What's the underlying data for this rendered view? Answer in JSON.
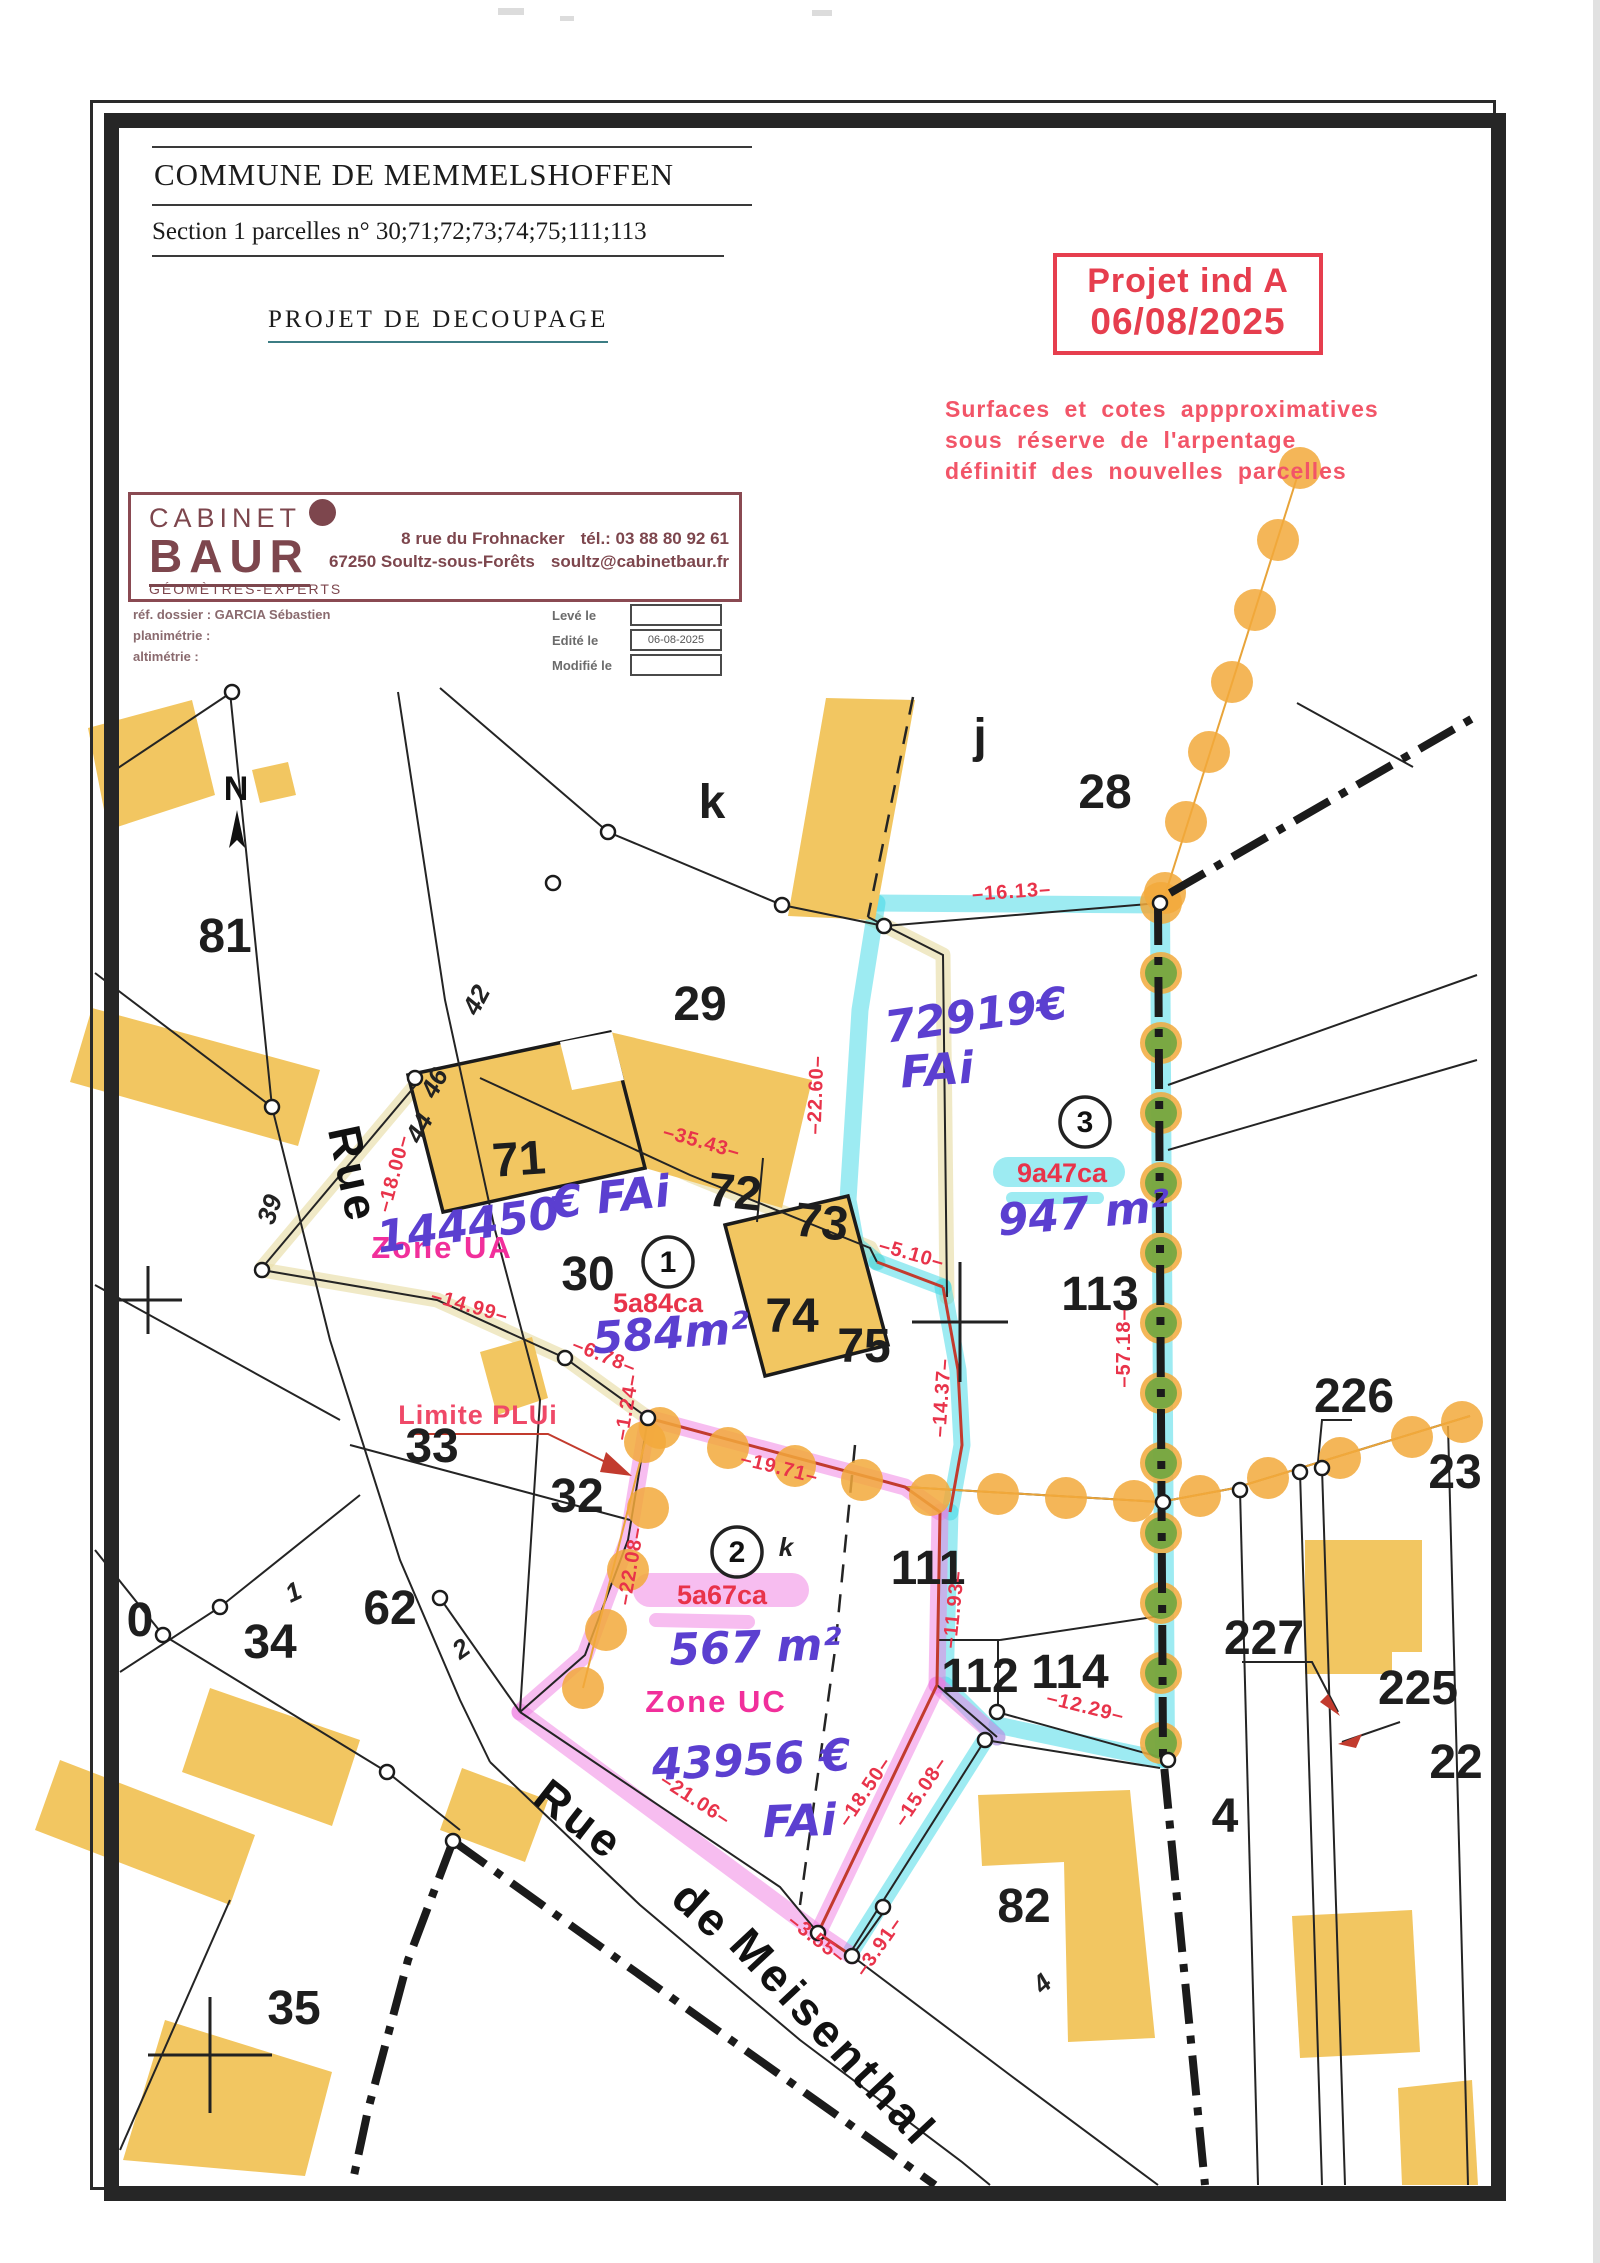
{
  "header": {
    "commune": "COMMUNE DE MEMMELSHOFFEN",
    "section": "Section 1 parcelles n° 30;71;72;73;74;75;111;113",
    "project_title": "PROJET DE DECOUPAGE"
  },
  "stamp": {
    "line1": "Projet ind A",
    "line2": "06/08/2025",
    "color": "#e63e4e"
  },
  "disclaimer": {
    "line1": "Surfaces et cotes appproximatives",
    "line2": "sous réserve de l'arpentage",
    "line3": "définitif des nouvelles parcelles"
  },
  "firm": {
    "name_top": "CABINET",
    "name_main": "BAUR",
    "subtitle": "GÉOMÈTRES-EXPERTS",
    "address_line1": "8 rue du Frohnacker",
    "address_line2": "67250 Soultz-sous-Forêts",
    "tel": "tél.: 03 88 80 92 61",
    "email": "soultz@cabinetbaur.fr",
    "brand_color": "#7d464d"
  },
  "file_info": {
    "ref_label": "réf. dossier : GARCIA Sébastien",
    "plan_label": "planimétrie :",
    "alt_label": "altimétrie :",
    "leve_label": "Levé le",
    "leve_value": "",
    "edite_label": "Edité le",
    "edite_value": "06-08-2025",
    "modifie_label": "Modifié le",
    "modifie_value": ""
  },
  "colors": {
    "building": "#f2c661",
    "orange_dot": "#f2a93b",
    "green_dot": "#5fa53e",
    "cyan_highlight": "#3bd7e6",
    "pink_highlight": "#f07ce2",
    "dim_red": "#e8334a",
    "zone_magenta": "#f12f9b",
    "handwriting_purple": "#5b3fd0"
  },
  "map": {
    "north": {
      "t": "N",
      "x": 236,
      "y": 800
    },
    "parcels": [
      {
        "t": "81",
        "x": 225,
        "y": 952,
        "s": 56
      },
      {
        "t": "29",
        "x": 700,
        "y": 1020,
        "s": 50
      },
      {
        "t": "28",
        "x": 1105,
        "y": 808,
        "s": 48
      },
      {
        "t": "k",
        "x": 712,
        "y": 818,
        "s": 56
      },
      {
        "t": "j",
        "x": 980,
        "y": 752,
        "s": 46
      },
      {
        "t": "71",
        "x": 520,
        "y": 1175,
        "s": 48,
        "r": -4
      },
      {
        "t": "72",
        "x": 733,
        "y": 1208,
        "s": 52,
        "r": 6
      },
      {
        "t": "73",
        "x": 820,
        "y": 1238,
        "s": 52,
        "r": 6
      },
      {
        "t": "30",
        "x": 588,
        "y": 1290,
        "s": 48
      },
      {
        "t": "74",
        "x": 792,
        "y": 1332,
        "s": 48
      },
      {
        "t": "75",
        "x": 864,
        "y": 1362,
        "s": 48
      },
      {
        "t": "113",
        "x": 1100,
        "y": 1310,
        "s": 46
      },
      {
        "t": "33",
        "x": 432,
        "y": 1462,
        "s": 46
      },
      {
        "t": "32",
        "x": 577,
        "y": 1512,
        "s": 44
      },
      {
        "t": "34",
        "x": 270,
        "y": 1658,
        "s": 44
      },
      {
        "t": "62",
        "x": 390,
        "y": 1624,
        "s": 44
      },
      {
        "t": "0",
        "x": 140,
        "y": 1636,
        "s": 44
      },
      {
        "t": "111",
        "x": 928,
        "y": 1584,
        "s": 42
      },
      {
        "t": "112",
        "x": 980,
        "y": 1692,
        "s": 42
      },
      {
        "t": "114",
        "x": 1070,
        "y": 1688,
        "s": 42
      },
      {
        "t": "226",
        "x": 1354,
        "y": 1412,
        "s": 42
      },
      {
        "t": "227",
        "x": 1264,
        "y": 1654,
        "s": 42
      },
      {
        "t": "225",
        "x": 1418,
        "y": 1704,
        "s": 42
      },
      {
        "t": "22",
        "x": 1456,
        "y": 1778,
        "s": 42
      },
      {
        "t": "23",
        "x": 1455,
        "y": 1488,
        "s": 42
      },
      {
        "t": "82",
        "x": 1024,
        "y": 1922,
        "s": 46
      },
      {
        "t": "35",
        "x": 294,
        "y": 2024,
        "s": 44
      },
      {
        "t": "4",
        "x": 1225,
        "y": 1832,
        "s": 46
      }
    ],
    "small_labels": [
      {
        "t": "39",
        "x": 278,
        "y": 1212,
        "r": -72
      },
      {
        "t": "42",
        "x": 484,
        "y": 1004,
        "r": -62
      },
      {
        "t": "46",
        "x": 442,
        "y": 1087,
        "r": -62
      },
      {
        "t": "44",
        "x": 427,
        "y": 1132,
        "r": -62
      },
      {
        "t": "1",
        "x": 297,
        "y": 1600,
        "r": -25
      },
      {
        "t": "2",
        "x": 466,
        "y": 1656,
        "r": -35
      },
      {
        "t": "4",
        "x": 1048,
        "y": 1990,
        "r": -42
      },
      {
        "t": "k",
        "x": 786,
        "y": 1556,
        "s": 40
      }
    ],
    "dims": [
      {
        "t": "–16.13–",
        "x": 1012,
        "y": 898,
        "r": -4
      },
      {
        "t": "–22.60–",
        "x": 822,
        "y": 1095,
        "r": -88
      },
      {
        "t": "–35.43–",
        "x": 700,
        "y": 1148,
        "r": 16
      },
      {
        "t": "–18.00–",
        "x": 400,
        "y": 1175,
        "r": -75
      },
      {
        "t": "–14.99–",
        "x": 468,
        "y": 1312,
        "r": 16
      },
      {
        "t": "–6.78–",
        "x": 602,
        "y": 1362,
        "r": 22
      },
      {
        "t": "–1.24–",
        "x": 633,
        "y": 1408,
        "r": -80
      },
      {
        "t": "–5.10–",
        "x": 910,
        "y": 1260,
        "r": 16
      },
      {
        "t": "–14.37–",
        "x": 948,
        "y": 1398,
        "r": -86
      },
      {
        "t": "–57.18–",
        "x": 1130,
        "y": 1348,
        "r": -90
      },
      {
        "t": "–19.71–",
        "x": 778,
        "y": 1474,
        "r": 14
      },
      {
        "t": "–22.08–",
        "x": 637,
        "y": 1567,
        "r": -80
      },
      {
        "t": "–11.93–",
        "x": 960,
        "y": 1610,
        "r": -84
      },
      {
        "t": "–12.29–",
        "x": 1084,
        "y": 1713,
        "r": 14
      },
      {
        "t": "–18.50–",
        "x": 870,
        "y": 1795,
        "r": -56
      },
      {
        "t": "–15.08–",
        "x": 926,
        "y": 1795,
        "r": -56
      },
      {
        "t": "–21.06–",
        "x": 692,
        "y": 1805,
        "r": 33
      },
      {
        "t": "–3.55–",
        "x": 813,
        "y": 1944,
        "r": 38
      },
      {
        "t": "–3.91–",
        "x": 884,
        "y": 1950,
        "r": -55
      }
    ],
    "areas": [
      {
        "t": "5a84ca",
        "x": 658,
        "y": 1312
      },
      {
        "t": "9a47ca",
        "x": 1062,
        "y": 1182
      },
      {
        "t": "5a67ca",
        "x": 722,
        "y": 1604
      }
    ],
    "lots": [
      {
        "n": "1",
        "x": 668,
        "y": 1262
      },
      {
        "n": "2",
        "x": 737,
        "y": 1552
      },
      {
        "n": "3",
        "x": 1085,
        "y": 1122
      }
    ],
    "zones": [
      {
        "t": "Zone UA",
        "x": 442,
        "y": 1258
      },
      {
        "t": "Zone UC",
        "x": 716,
        "y": 1712
      }
    ],
    "limite": {
      "t": "Limite PLUi",
      "x": 478,
      "y": 1424
    },
    "handwriting": [
      {
        "t": "144450",
        "x": 470,
        "y": 1240,
        "s": 46,
        "r": -8
      },
      {
        "t": "€ FAi",
        "x": 612,
        "y": 1212,
        "s": 38,
        "r": -6,
        "c": "#6a2d8f"
      },
      {
        "t": "72919€",
        "x": 978,
        "y": 1030,
        "s": 48,
        "r": -8
      },
      {
        "t": "FAi",
        "x": 938,
        "y": 1085,
        "s": 42,
        "r": -4
      },
      {
        "t": "947 m²",
        "x": 1085,
        "y": 1228,
        "s": 40,
        "r": -5
      },
      {
        "t": "584m²",
        "x": 672,
        "y": 1348,
        "s": 38,
        "r": -4
      },
      {
        "t": "567 m²",
        "x": 756,
        "y": 1662,
        "s": 46,
        "r": -2
      },
      {
        "t": "43956 €",
        "x": 752,
        "y": 1775,
        "s": 48,
        "r": -3
      },
      {
        "t": "FAi",
        "x": 800,
        "y": 1836,
        "s": 42,
        "r": -2
      }
    ],
    "streets": [
      {
        "t": "Rue",
        "x": 338,
        "y": 1178,
        "s": 46,
        "r": 78
      },
      {
        "t": "Rue",
        "x": 570,
        "y": 1832,
        "s": 44,
        "r": 38
      },
      {
        "t": "de",
        "x": 692,
        "y": 1922,
        "s": 44,
        "r": 42
      },
      {
        "t": "Meisenthal",
        "x": 822,
        "y": 2048,
        "s": 44,
        "r": 47
      }
    ]
  }
}
